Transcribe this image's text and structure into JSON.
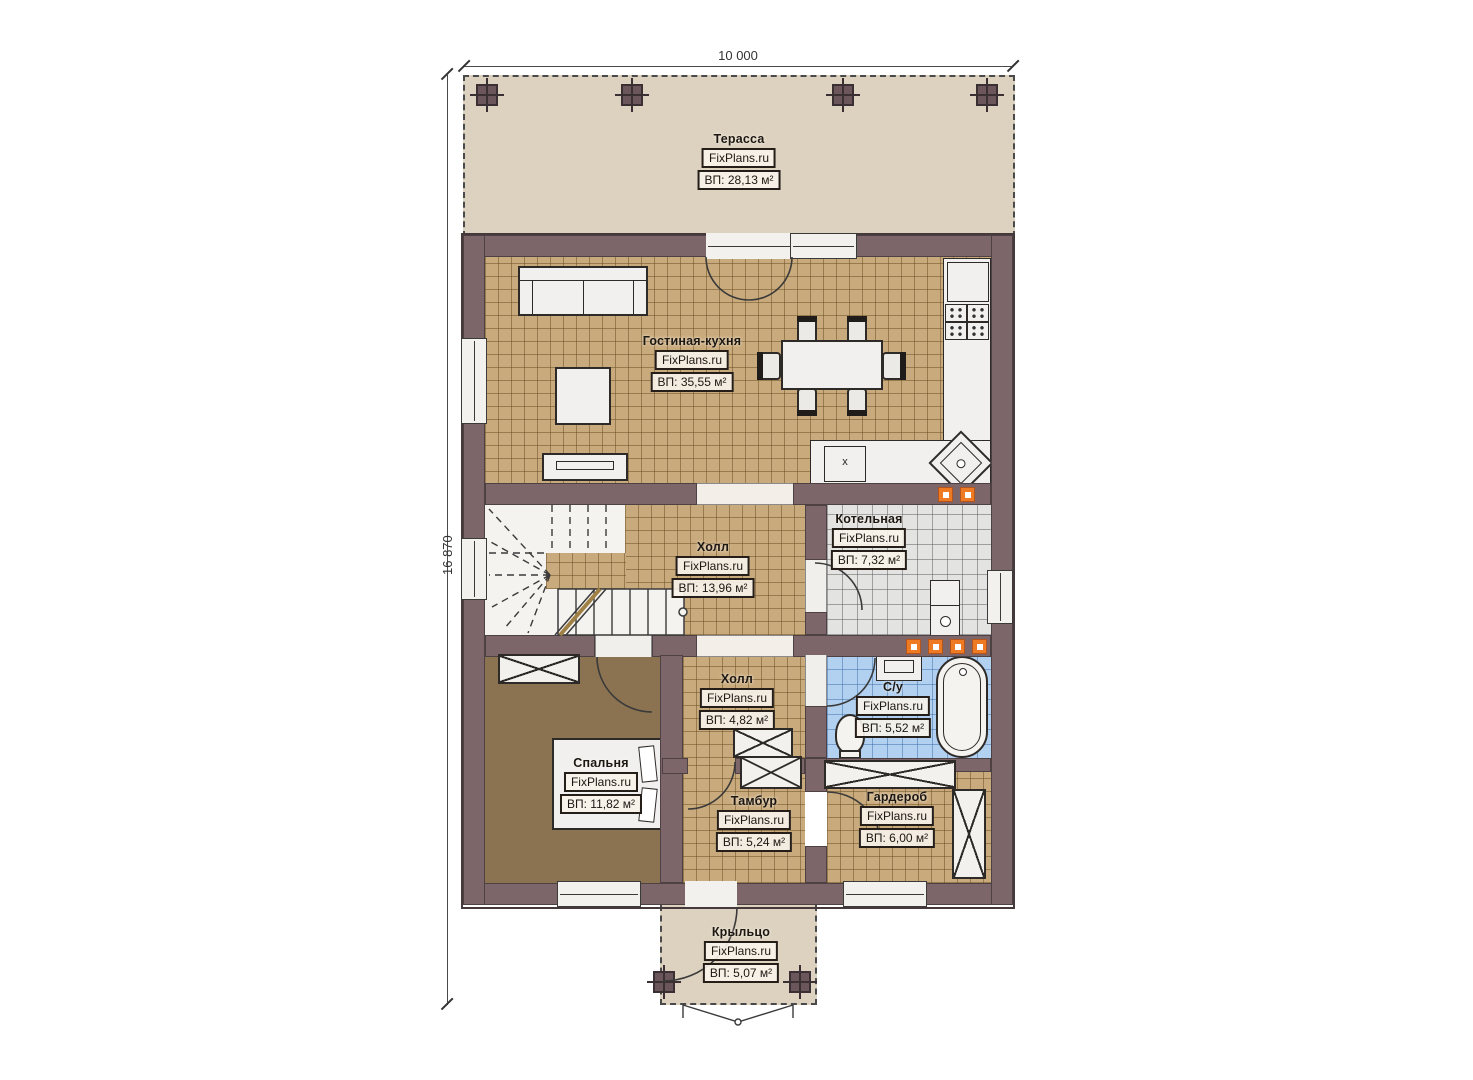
{
  "plan": {
    "brand": "FixPlans.ru",
    "dimensions": {
      "width_label": "10 000",
      "height_label": "16 870"
    },
    "rooms": {
      "terrace": {
        "name": "Терасса",
        "brand": "FixPlans.ru",
        "area": "ВП: 28,13 м²"
      },
      "living_kitchen": {
        "name": "Гостиная-кухня",
        "brand": "FixPlans.ru",
        "area": "ВП: 35,55 м²"
      },
      "hall_1": {
        "name": "Холл",
        "brand": "FixPlans.ru",
        "area": "ВП: 13,96 м²"
      },
      "boiler": {
        "name": "Котельная",
        "brand": "FixPlans.ru",
        "area": "ВП: 7,32 м²"
      },
      "hall_2": {
        "name": "Холл",
        "brand": "FixPlans.ru",
        "area": "ВП: 4,82 м²"
      },
      "bathroom": {
        "name": "С/у",
        "brand": "FixPlans.ru",
        "area": "ВП: 5,52 м²"
      },
      "bedroom": {
        "name": "Спальня",
        "brand": "FixPlans.ru",
        "area": "ВП: 11,82 м²"
      },
      "vestibule": {
        "name": "Тамбур",
        "brand": "FixPlans.ru",
        "area": "ВП: 5,24 м²"
      },
      "wardrobe": {
        "name": "Гардероб",
        "brand": "FixPlans.ru",
        "area": "ВП: 6,00 м²"
      },
      "porch": {
        "name": "Крыльцо",
        "brand": "FixPlans.ru",
        "area": "ВП: 5,07 м²"
      }
    },
    "markers": {
      "cooktop_label": "x"
    },
    "colors": {
      "wall": "#7c666a",
      "terrace_fill": "#ddd2bf",
      "tile_tan": "#c9aa7c",
      "tile_gray": "#e3e3e2",
      "tile_blue": "#b2d0f0",
      "bedroom_floor": "#8b7352",
      "vent_orange": "#ee7a24",
      "furniture_fill": "#f1f0ee",
      "line": "#2e2a28"
    }
  }
}
